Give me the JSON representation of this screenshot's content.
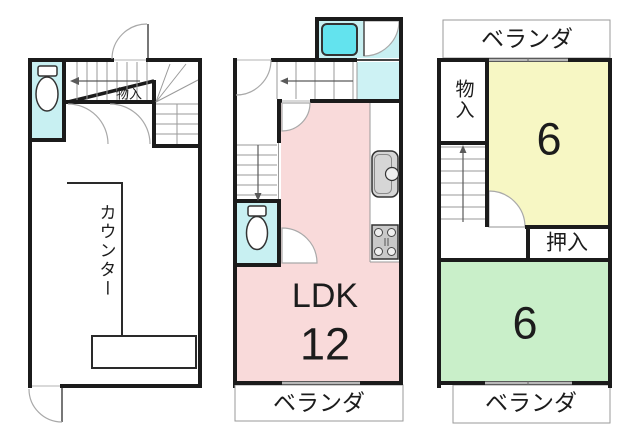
{
  "labels": {
    "f1_storage": "物入",
    "f1_counter": "カウンター",
    "f2_ldk": "LDK",
    "f2_ldk_size": "12",
    "f2_veranda": "ベランダ",
    "f3_veranda_top": "ベランダ",
    "f3_storage": "物入",
    "f3_room_north_size": "6",
    "f3_closet": "押入",
    "f3_room_south_size": "6",
    "f3_veranda_bottom": "ベランダ"
  },
  "icons": {
    "toilet_1f": "toilet-icon",
    "toilet_2f": "toilet-icon",
    "bathtub_2f": "bathtub-icon",
    "sink_2f": "kitchen-sink-icon",
    "stove_2f": "gas-stove-icon",
    "stairs_up_arrows": "stair-direction-arrow"
  },
  "colors": {
    "wall": "#1b1b1b",
    "cyan_room": "#c8f0f2",
    "washroom": "#cdf2f4",
    "bathtub": "#63e3ee",
    "ldk_pink": "#f9dada",
    "room_yellow": "#f7f7c4",
    "room_green": "#c9efc9",
    "window": "#b8b8b8",
    "fixture_gray": "#d6d6d6",
    "stove_gray": "#c9c9c9"
  }
}
